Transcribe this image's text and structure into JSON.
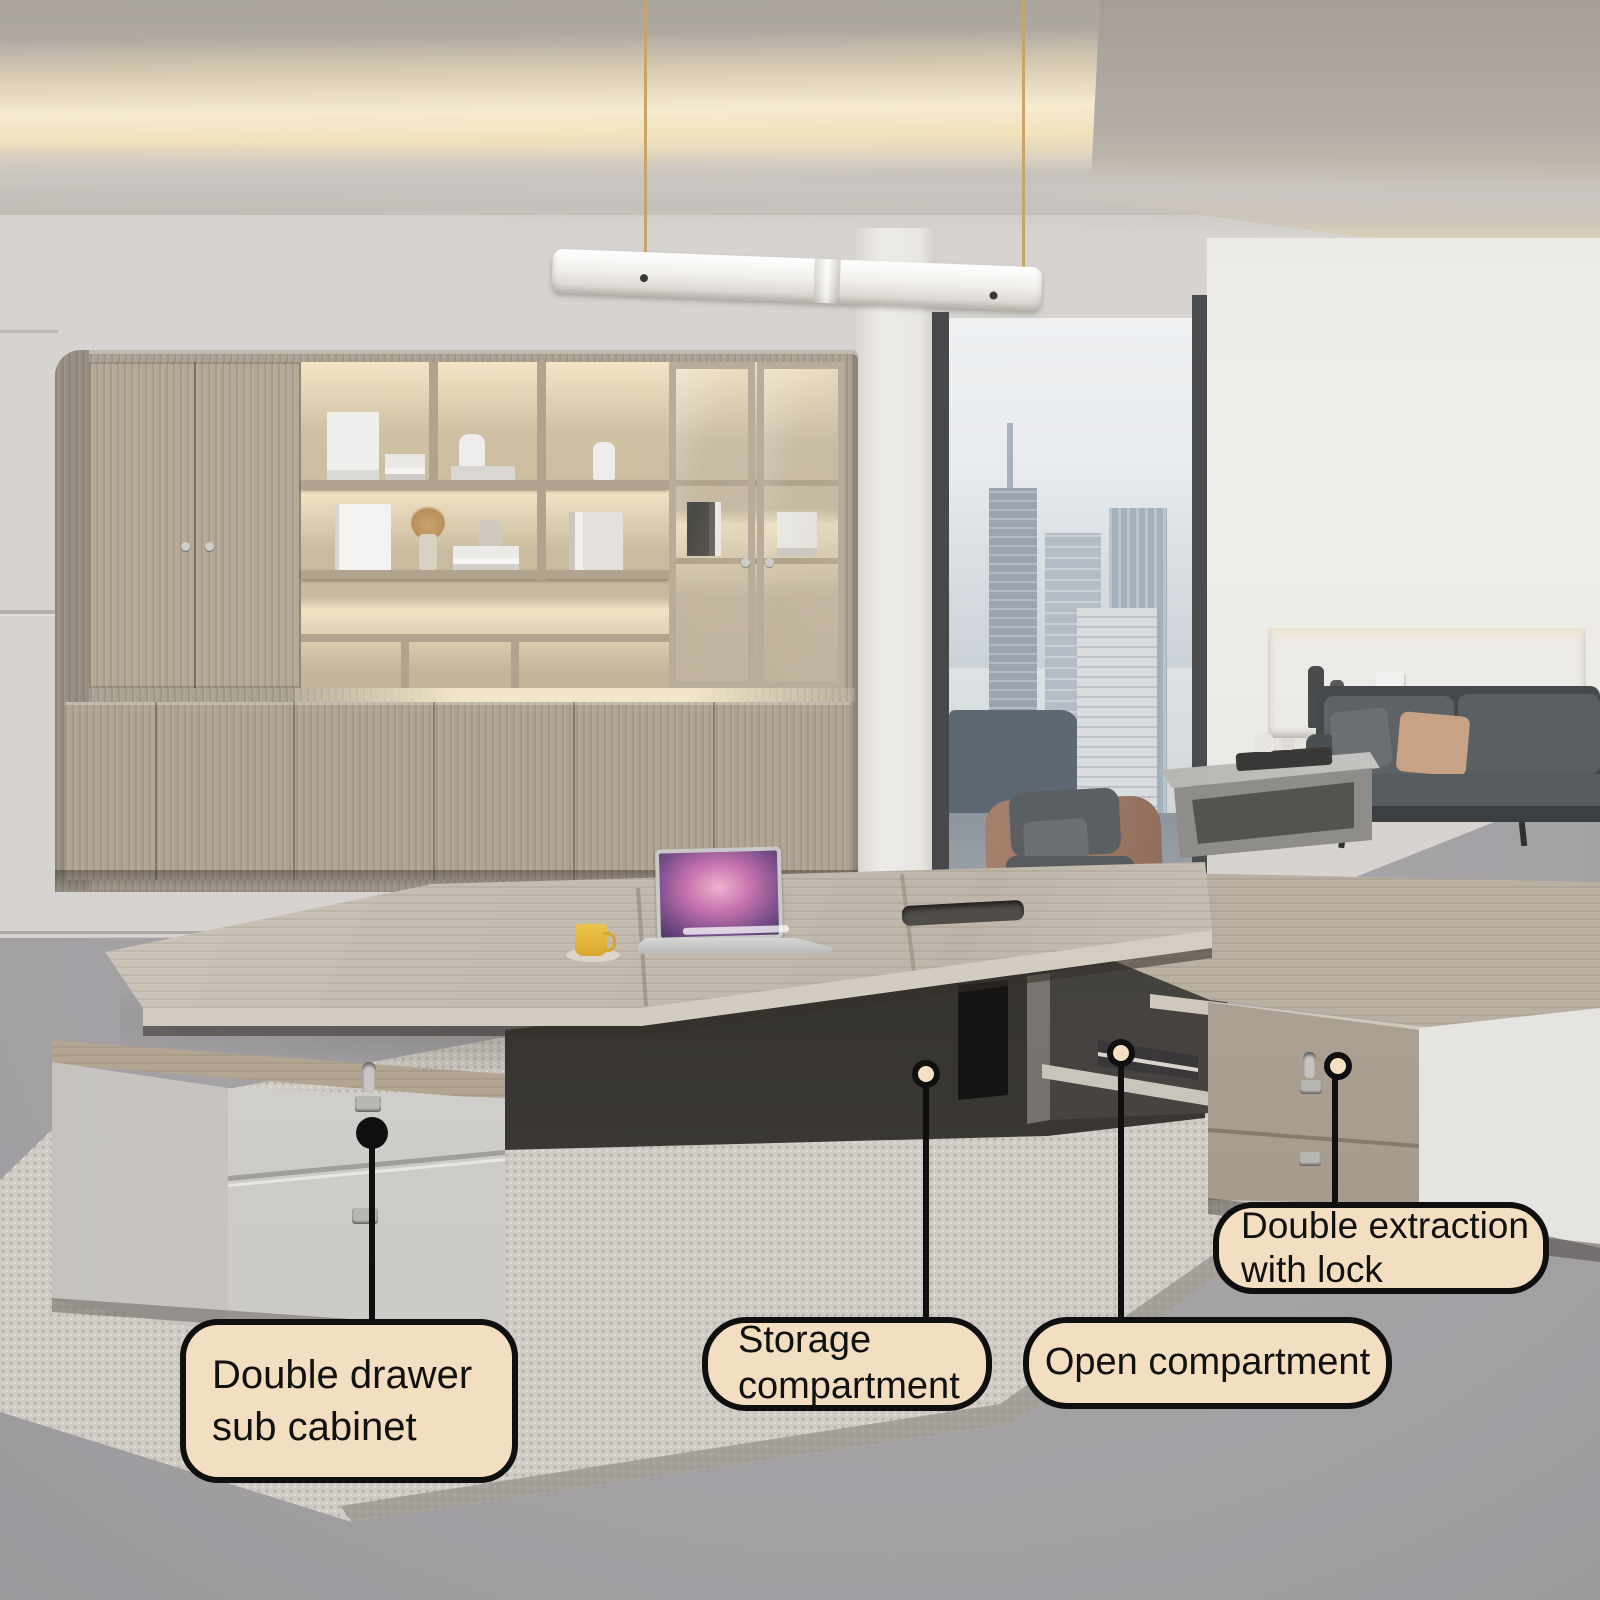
{
  "scene": {
    "description": "Modern executive office: L-shaped desk with pedestal cabinets, wood bookcase wall, pendant light, lounge sofa set and floor-to-ceiling city window",
    "objects": [
      "bookcase",
      "pendant-light",
      "window-city-view",
      "sofa",
      "armchair",
      "coffee-table",
      "wall-niche",
      "executive-desk",
      "desk-return",
      "left-pedestal",
      "right-cabinet",
      "laptop",
      "coffee-cup",
      "rug"
    ]
  },
  "annotations": {
    "style": {
      "bubble_bg": "#f3dec1",
      "bubble_border": "#0f0f0f",
      "text_color": "#111111",
      "dot_fill": "#f4e0c2",
      "dot_ring": "#0f0f0f",
      "leader_color": "#0f0f0f"
    },
    "items": [
      {
        "id": "double-drawer-sub-cabinet",
        "label": "Double drawer sub cabinet",
        "marker": "solid-black-dot"
      },
      {
        "id": "storage-compartment",
        "label": "Storage compartment",
        "marker": "ring-dot"
      },
      {
        "id": "open-compartment",
        "label": "Open compartment",
        "marker": "ring-dot"
      },
      {
        "id": "double-extraction-with-lock",
        "label": "Double extraction with lock",
        "marker": "ring-dot"
      }
    ]
  },
  "palette": {
    "cove_light": "#f6ead0",
    "ceiling_grey": "#b4afa9",
    "wall_grey": "#d6d3d0",
    "wood_greige": "#b5a897",
    "desk_top": "#c8c1b4",
    "pedestal_white": "#dcdad6",
    "floor_grey": "#a2a0a3",
    "rug_beige": "#cfccc5",
    "sofa_grey": "#5c6163",
    "leather_tan": "#9d7a66",
    "pillow_tan": "#c8a284",
    "cable_gold": "#c8a668",
    "cup_yellow": "#e8b93a"
  }
}
